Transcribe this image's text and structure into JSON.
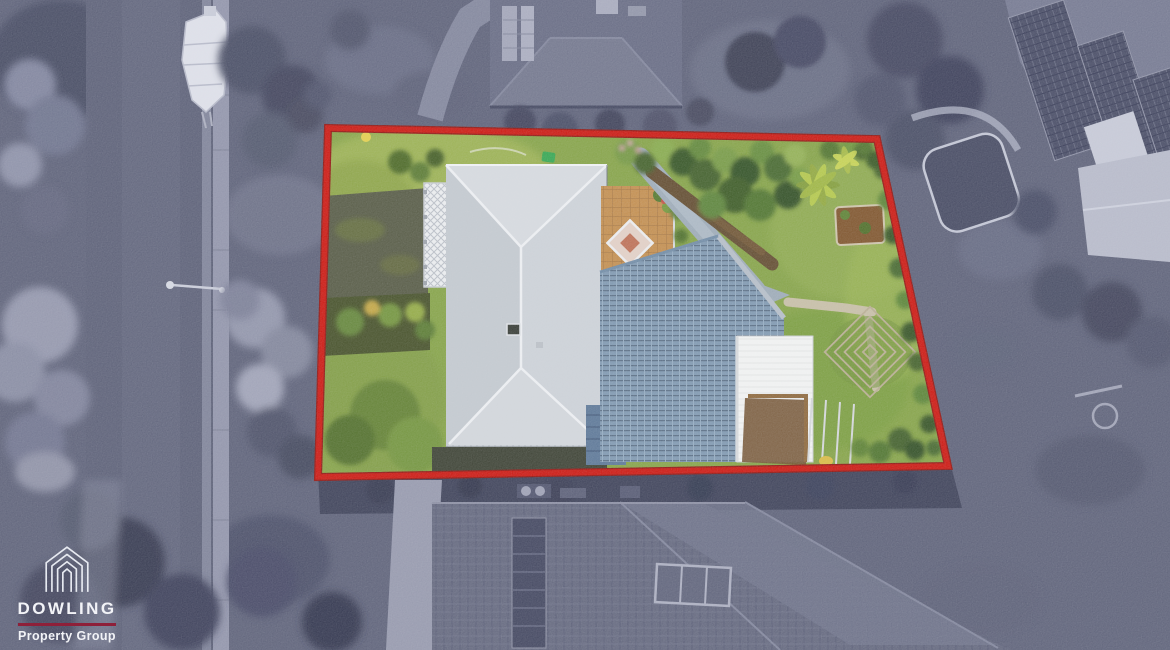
{
  "logo": {
    "name": "DOWLING",
    "tagline": "Property Group",
    "icon": "nested-house-outline-icon"
  },
  "colors": {
    "boundary_red": "#cb0d05",
    "boundary_red_dark": "#8e0b06",
    "logo_divider_maroon": "#8e2039",
    "logo_text_white": "#f2f3f7",
    "lot_lawn_green": "#81a03f",
    "surroundings_gray": "#585c74",
    "main_roof_gray": "#c9ced4",
    "pergola_roof_blue": "#7b95ae",
    "garage_roof_white": "#f3f4f3",
    "courtyard_pavers_tan": "#c28a47"
  }
}
